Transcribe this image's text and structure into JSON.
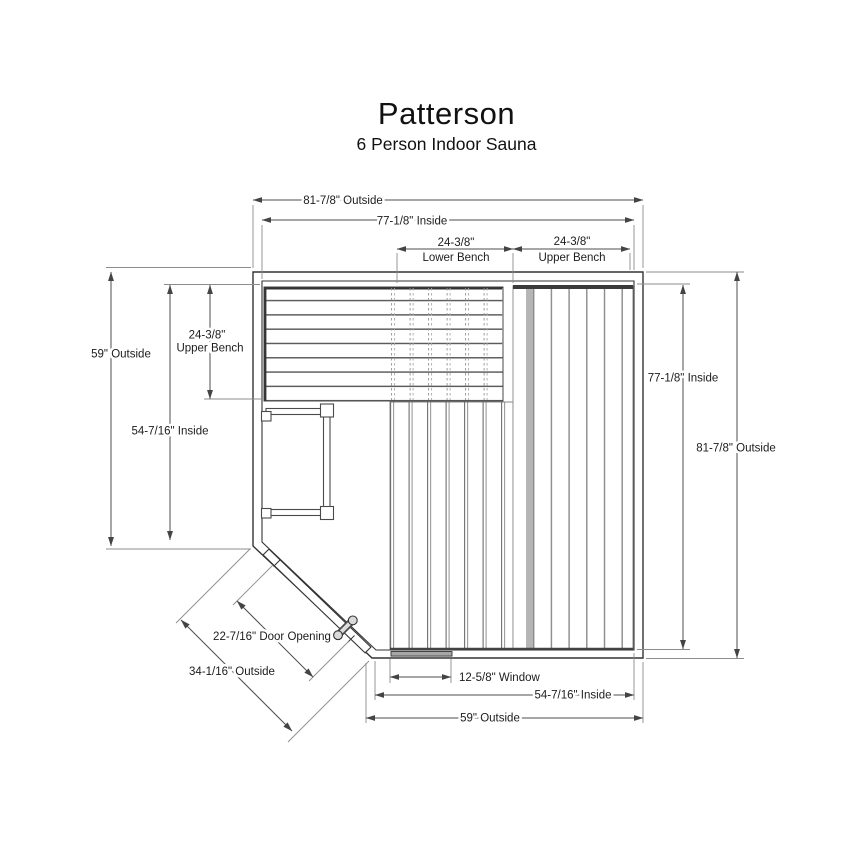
{
  "title": "Patterson",
  "subtitle": "6 Person Indoor Sauna",
  "dims": {
    "top_outside": "81-7/8\" Outside",
    "top_inside": "77-1/8\" Inside",
    "lower_bench": {
      "value": "24-3/8\"",
      "label": "Lower Bench"
    },
    "upper_bench_top": {
      "value": "24-3/8\"",
      "label": "Upper Bench"
    },
    "upper_bench_left": {
      "value": "24-3/8\"",
      "label": "Upper Bench"
    },
    "left_outside": "59\" Outside",
    "left_inside": "54-7/16\" Inside",
    "right_inside": "77-1/8\" Inside",
    "right_outside": "81-7/8\" Outside",
    "window": "12-5/8\" Window",
    "bottom_inside": "54-7/16\" Inside",
    "bottom_outside": "59\" Outside",
    "door_opening": "22-7/16\" Door Opening",
    "corner_outside": "34-1/16\" Outside"
  },
  "colors": {
    "line": "#333333",
    "dimension": "#4d4d4d",
    "extension": "#8c8c8c",
    "background": "#ffffff"
  }
}
